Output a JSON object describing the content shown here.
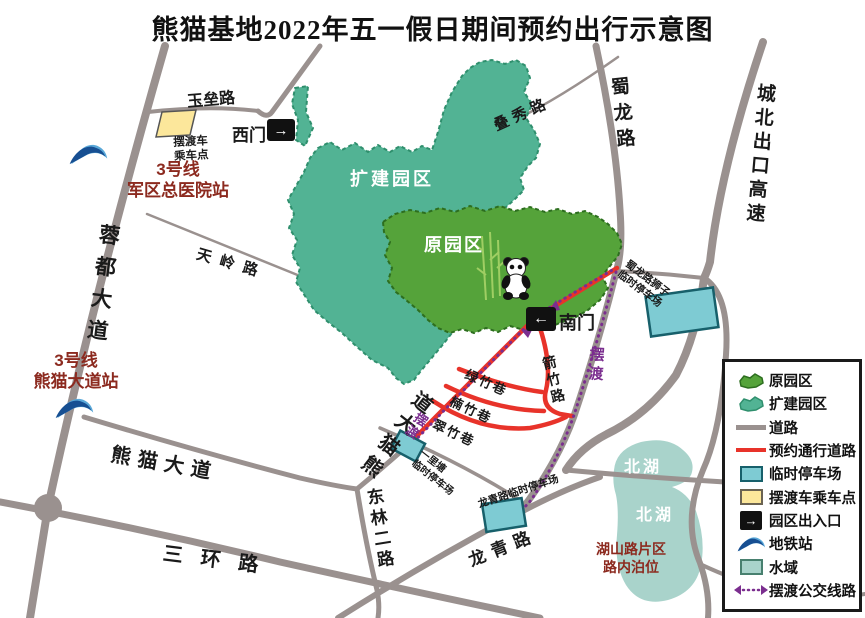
{
  "title": "熊猫基地2022年五一假日期间预约出行示意图",
  "colors": {
    "original_area": "#55a33a",
    "expansion_area": "#52b394",
    "road": "#9a918f",
    "reserved_road": "#e8332a",
    "parking": "#7ecbd3",
    "shuttle_point": "#fce79b",
    "water": "#a9d3cb",
    "shuttle_route": "#7b2e8f",
    "station_text": "#8c2a1f"
  },
  "areas": {
    "expansion": "扩建园区",
    "original": "原园区",
    "lake_upper": "北湖",
    "lake_lower": "北湖"
  },
  "roads": {
    "yulei": "玉垒路",
    "diexiu": "叠秀路",
    "shulong": "蜀龙路",
    "chengbei": "城北出口高速",
    "rongdu": "蓉都大道",
    "tianling": "天岭路",
    "panda_ave_west": "熊猫大道",
    "panda_ave_ne": "熊猫大道",
    "sanhuan": "三环路",
    "donglin": "东林二路",
    "longqing": "龙青路",
    "jianzhu": "箭竹路",
    "lvzhu": "绿竹巷",
    "nanzhu": "楠竹巷",
    "cuizhu": "翠竹巷"
  },
  "gates": {
    "west": "西门",
    "west_arrow": "→",
    "south": "南门",
    "south_arrow": "←"
  },
  "stations": {
    "hospital": {
      "line": "3号线",
      "name": "军区总医院站"
    },
    "panda_ave": {
      "line": "3号线",
      "name": "熊猫大道站"
    }
  },
  "shuttle": {
    "label_shulong": "摆渡",
    "label_diagonal": "摆渡",
    "point_line1": "摆渡车",
    "point_line2": "乘车点"
  },
  "parkings": {
    "shulong_lion_line1": "蜀龙路狮子",
    "shulong_lion_line2": "临时停车场",
    "yilitang_line1": "一里塘",
    "yilitang_line2": "临时停车场",
    "longqing": "龙青路临时停车场"
  },
  "notes": {
    "hushan_line1": "湖山路片区",
    "hushan_line2": "路内泊位"
  },
  "legend": {
    "gate_arrow": "→",
    "items": [
      {
        "icon": "original-area",
        "label": "原园区"
      },
      {
        "icon": "expansion-area",
        "label": "扩建园区"
      },
      {
        "icon": "road",
        "label": "道路"
      },
      {
        "icon": "reserved-road",
        "label": "预约通行道路"
      },
      {
        "icon": "parking",
        "label": "临时停车场"
      },
      {
        "icon": "shuttle-point",
        "label": "摆渡车乘车点"
      },
      {
        "icon": "gate",
        "label": "园区出入口"
      },
      {
        "icon": "metro",
        "label": "地铁站"
      },
      {
        "icon": "water",
        "label": "水域"
      },
      {
        "icon": "shuttle-route",
        "label": "摆渡公交线路"
      }
    ]
  }
}
